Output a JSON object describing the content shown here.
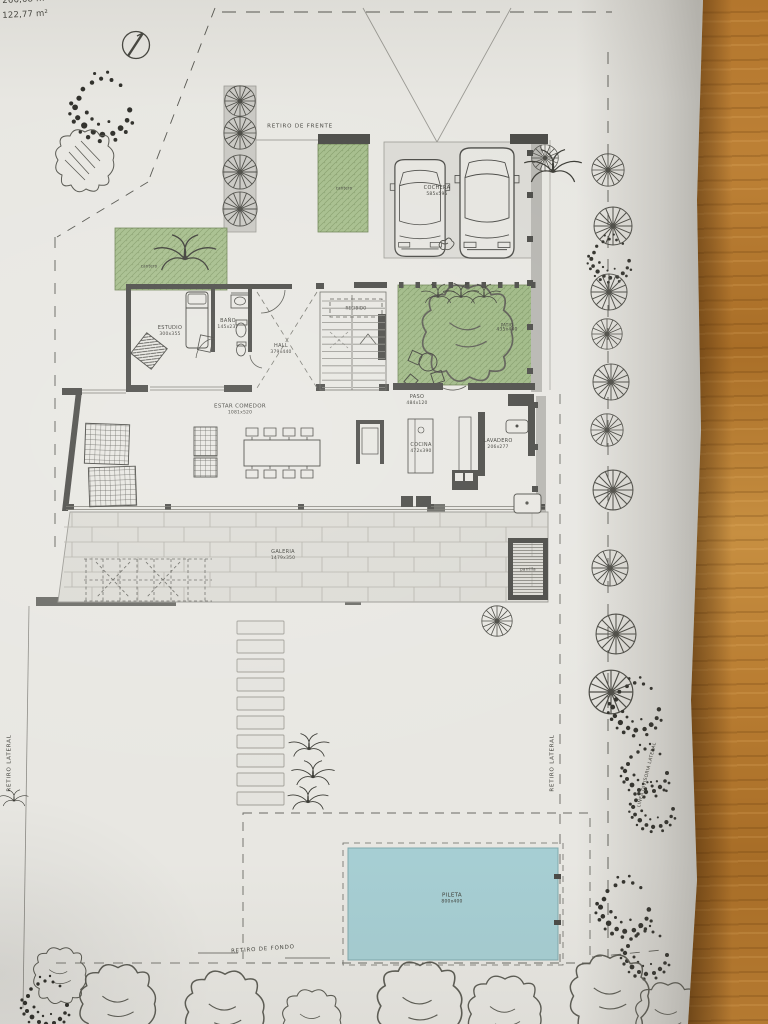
{
  "photo": {
    "surface": "wooden-table",
    "paper_color": "#e8e7e2",
    "wood_color": "#b3762d"
  },
  "plan": {
    "area_labels": [
      "266,08 m²",
      "122,77 m²"
    ],
    "site": {
      "retiro_frente": "RETIRO DE FRENTE",
      "retiro_fondo": "RETIRO DE FONDO",
      "retiro_lateral_left": "RETIRO LATERAL",
      "retiro_lateral_right": "RETIRO LATERAL",
      "linea_divisoria_lateral": "LINEA DIVISORIA LATERAL"
    },
    "rooms": {
      "cochera": {
        "name": "COCHERA",
        "dims": "585x595"
      },
      "estudio": {
        "name": "ESTUDIO",
        "dims": "300x355"
      },
      "bano": {
        "name": "BAÑO",
        "dims": "145x237"
      },
      "hall": {
        "name": "HALL",
        "dims": "379x440"
      },
      "recibido": {
        "name": "RECIBIDO",
        "dims": ""
      },
      "patio": {
        "name": "PATIO",
        "dims": "435x440"
      },
      "estar_comedor": {
        "name": "ESTAR COMEDOR",
        "dims": "1081x520"
      },
      "paso": {
        "name": "PASO",
        "dims": "484x120"
      },
      "cocina": {
        "name": "COCINA",
        "dims": "472x390"
      },
      "lavadero": {
        "name": "LAVADERO",
        "dims": "206x277"
      },
      "galeria": {
        "name": "GALERIA",
        "dims": "1479x350"
      },
      "parrilla": {
        "name": "parrilla",
        "dims": ""
      },
      "pileta": {
        "name": "PILETA",
        "dims": "800x400"
      },
      "cantero_strip": {
        "name": "cantero",
        "dims": ""
      },
      "cantero_left": {
        "name": "cantero",
        "dims": ""
      }
    },
    "colors": {
      "planting_green": "#a5bd8b",
      "pool_water": "#a6ced3",
      "wall_dark": "#4b4b47",
      "paving_gray": "#dcdbd5"
    }
  }
}
